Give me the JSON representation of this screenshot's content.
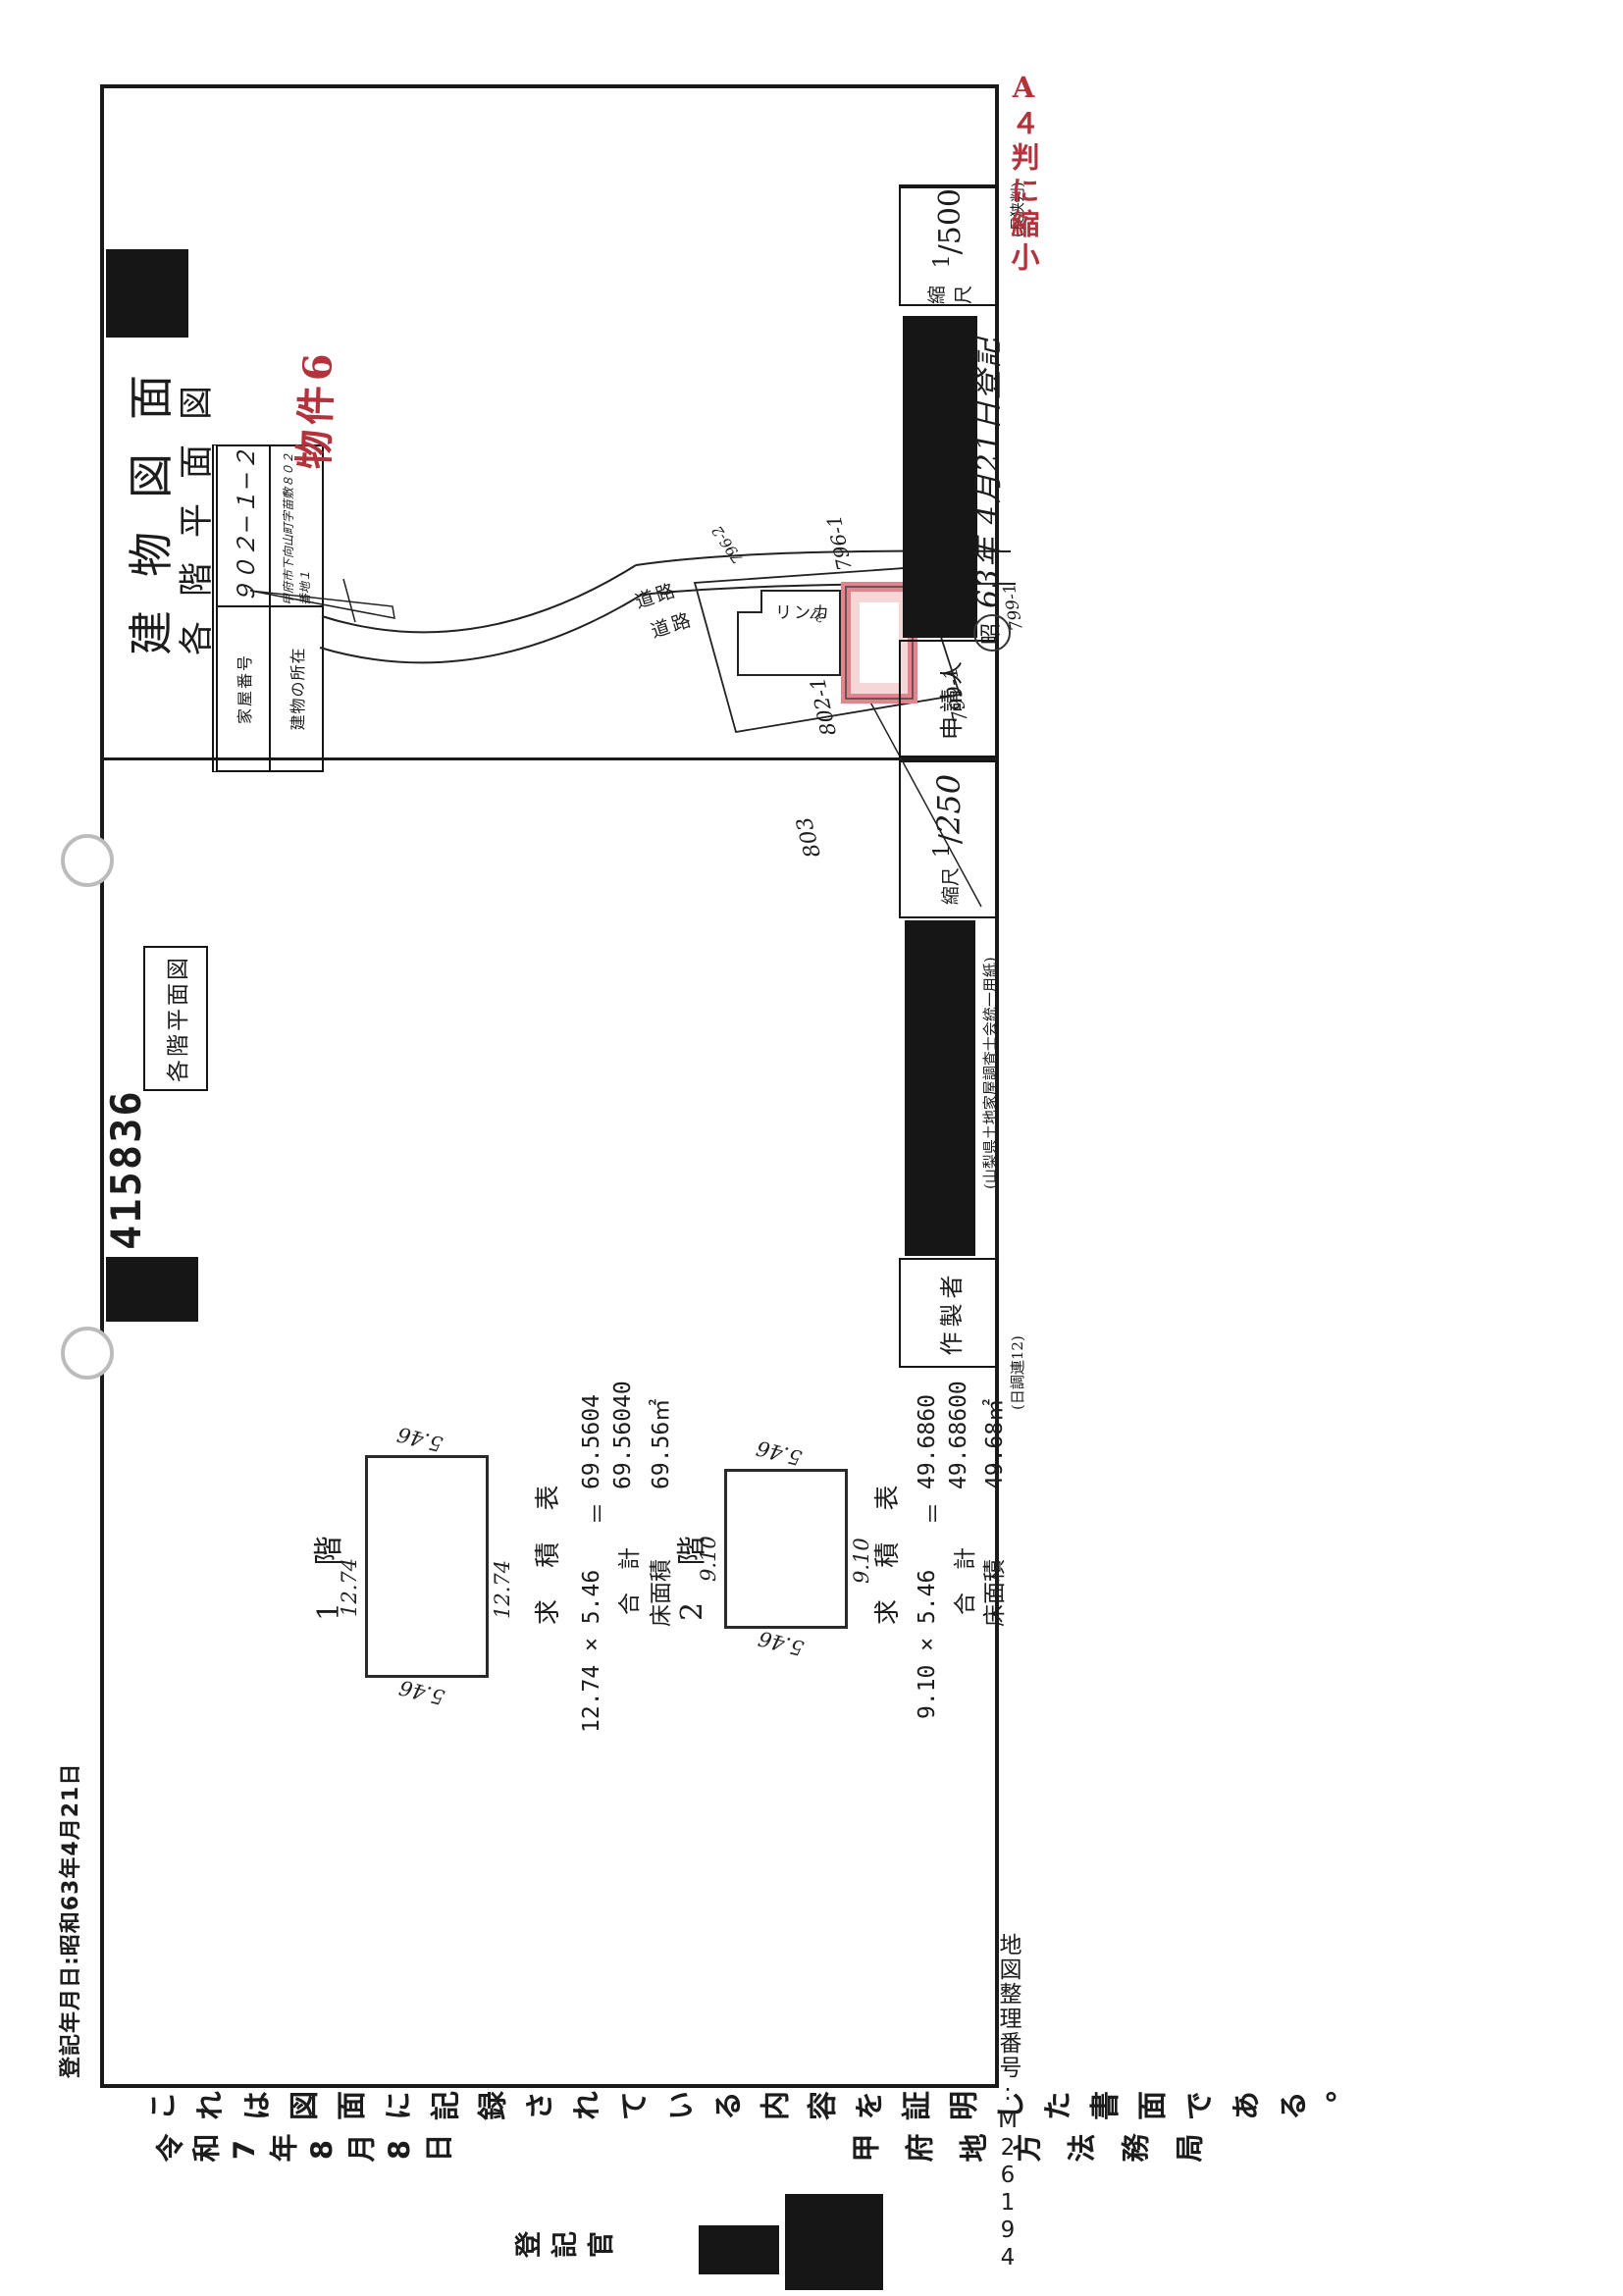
{
  "annotations": {
    "registration_date": "登記年月日:昭和63年4月21日",
    "a4_reduction": "A４判に縮小",
    "map_reference": "地図整理番号:M26194",
    "property_tag": "物件6"
  },
  "titles": {
    "building_drawing": "建物図面",
    "floor_plan": "各階平面図",
    "left_section_box": "各階平面図",
    "document_number": "415836"
  },
  "info_table": {
    "rows": [
      {
        "label": "家屋番号",
        "value": "９０２−１−２"
      },
      {
        "label": "建物の所在",
        "value": "甲府市下向山町字苗敷８０２番地１"
      }
    ]
  },
  "survey": {
    "table_title": "求 積 表",
    "floors": [
      {
        "name": "1 階",
        "width_dim": "12.74",
        "height_dim_left": "5.46",
        "height_dim_right": "5.46",
        "width_dim_bottom": "12.74",
        "formula_left": "12.74 × 5.46",
        "equals": "＝",
        "result": "69.5604",
        "total_label": "合　計",
        "total": "69.56040",
        "area_label": "床面積",
        "area": "69.56㎡"
      },
      {
        "name": "2 階",
        "width_dim": "9.10",
        "height_dim_left": "5.46",
        "height_dim_right": "5.46",
        "width_dim_bottom": "9.10",
        "formula_left": "9.10 × 5.46",
        "equals": "＝",
        "result": "49.6860",
        "total_label": "合　計",
        "total": "49.68600",
        "area_label": "床面積",
        "area": "49.68㎡"
      }
    ]
  },
  "site_map": {
    "parcel_802": "802-1",
    "parcel_799a": "799-1",
    "parcel_799b": "799-1",
    "parcel_803": "803",
    "parcel_796_1": "796-1",
    "parcel_796_2": "796-2",
    "building_label": "リンカ",
    "road_label_1": "道路",
    "road_label_2": "道路",
    "small_mark": "31"
  },
  "form_boxes": {
    "scale_label": "縮尺",
    "scale_right_num": "1",
    "scale_right_den": "500",
    "applicant_label": "申請人",
    "scale_left_num": "1",
    "scale_left_den": "250",
    "preparer_label": "作製者",
    "stamp_circle": "昭",
    "stamp_text": "63年 4月21日登記",
    "vendor_note": "(山梨県土地家屋調査士会統一用紙)",
    "paper_note_left": "(日調連12)",
    "paper_note_right": "(長狭判)"
  },
  "certification": {
    "statement": "これは図面に記録されている内容を証明した書面である。",
    "date": "令和7年8月8日",
    "office": "甲府地方法務局",
    "officer": "登記官"
  }
}
